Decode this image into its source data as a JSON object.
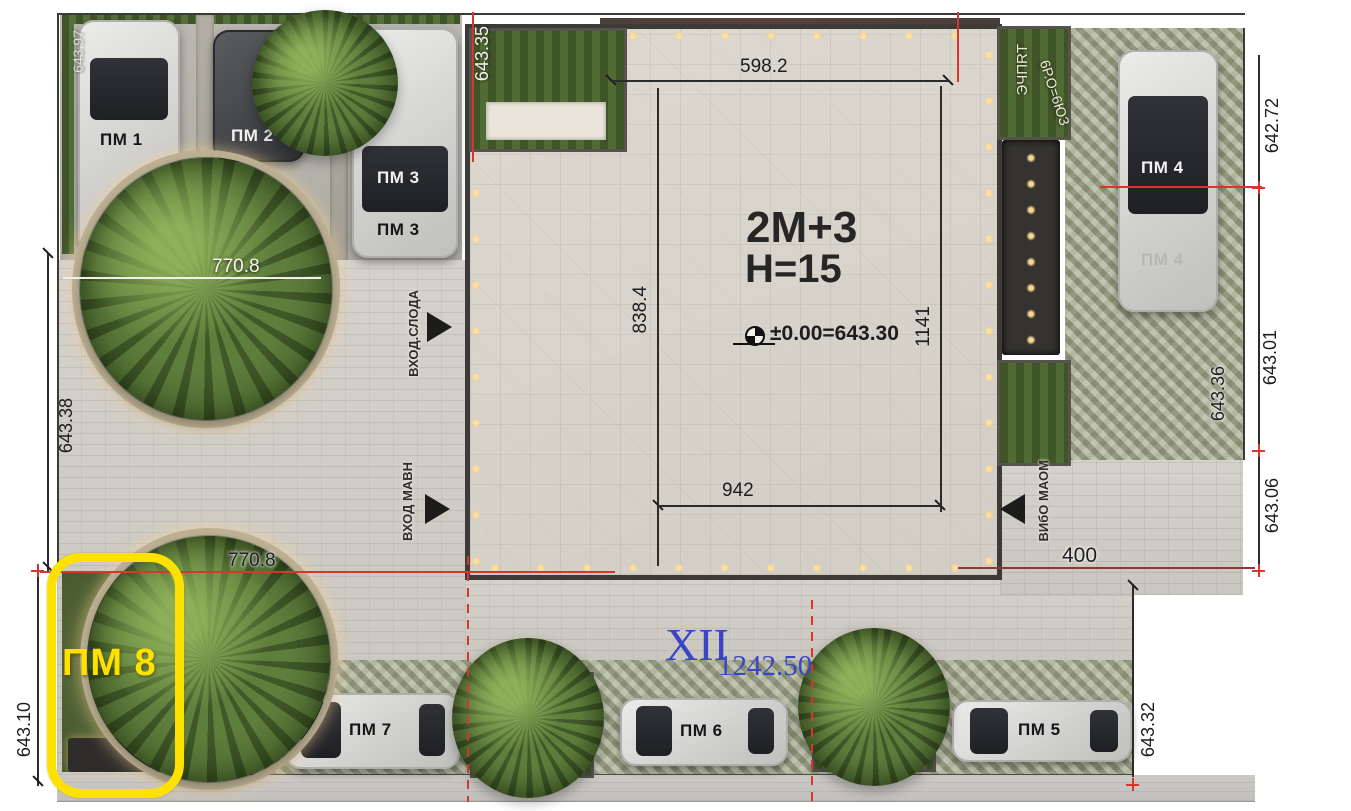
{
  "building": {
    "storeys_label": "2M+3",
    "height_label": "H=15",
    "level_mark": "±0.00=643.30"
  },
  "dimensions": {
    "top_width": "598.2",
    "inner_left_height": "838.4",
    "inner_right_height": "1141",
    "inner_bottom_width": "942",
    "upper_tree_width": "770.8",
    "lower_tree_width": "770.8",
    "right_setback": "400",
    "frontage_length": "1242.50",
    "block_numeral": "XII"
  },
  "elevations": {
    "top_left_garbled": "643.97",
    "courtyard_top": "643.35",
    "left": "643.38",
    "bottom_left": "643.10",
    "right_top": "642.72",
    "right_upper": "643.01",
    "parking_inner": "643.36",
    "right_lower": "643.06",
    "bottom_right": "643.32"
  },
  "parking": {
    "pm1": "ПМ 1",
    "pm2": "ПМ 2",
    "pm3_windshield": "ПМ 3",
    "pm3_hood": "ПМ 3",
    "pm4_roof": "ПМ 4",
    "pm4_hood": "ПМ 4",
    "pm5": "ПМ 5",
    "pm6": "ПМ 6",
    "pm7": "ПМ 7",
    "pm8_highlight": "ПМ 8"
  },
  "entrances": {
    "left_upper": "ВХОД.СЛОДА",
    "left_lower": "ВХОД МАВН",
    "right": "ВИбО МАОМ"
  },
  "misc": {
    "top_right_vertical": "ЭЧПRТ",
    "top_right_scatter": "6Р.О=6ЮЗ"
  },
  "colors": {
    "highlight_yellow": "#ffe100",
    "annotation_blue": "#3b44c4",
    "dimension_red": "#d4372b"
  }
}
